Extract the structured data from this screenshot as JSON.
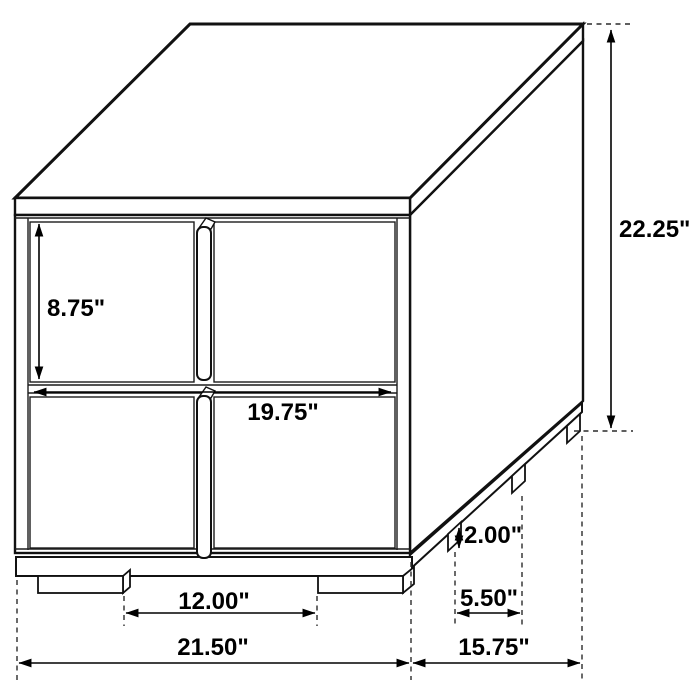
{
  "colors": {
    "background": "#ffffff",
    "line": "#111111",
    "text": "#000000"
  },
  "diagram": {
    "subject": "two-drawer nightstand dimension drawing",
    "dimensions": {
      "drawer_height": "8.75\"",
      "front_width": "19.75\"",
      "overall_height": "22.25\"",
      "foot_height": "2.00\"",
      "side_foot_spacing": "5.50\"",
      "front_foot_spacing": "12.00\"",
      "overall_width": "21.50\"",
      "overall_depth": "15.75\""
    }
  }
}
